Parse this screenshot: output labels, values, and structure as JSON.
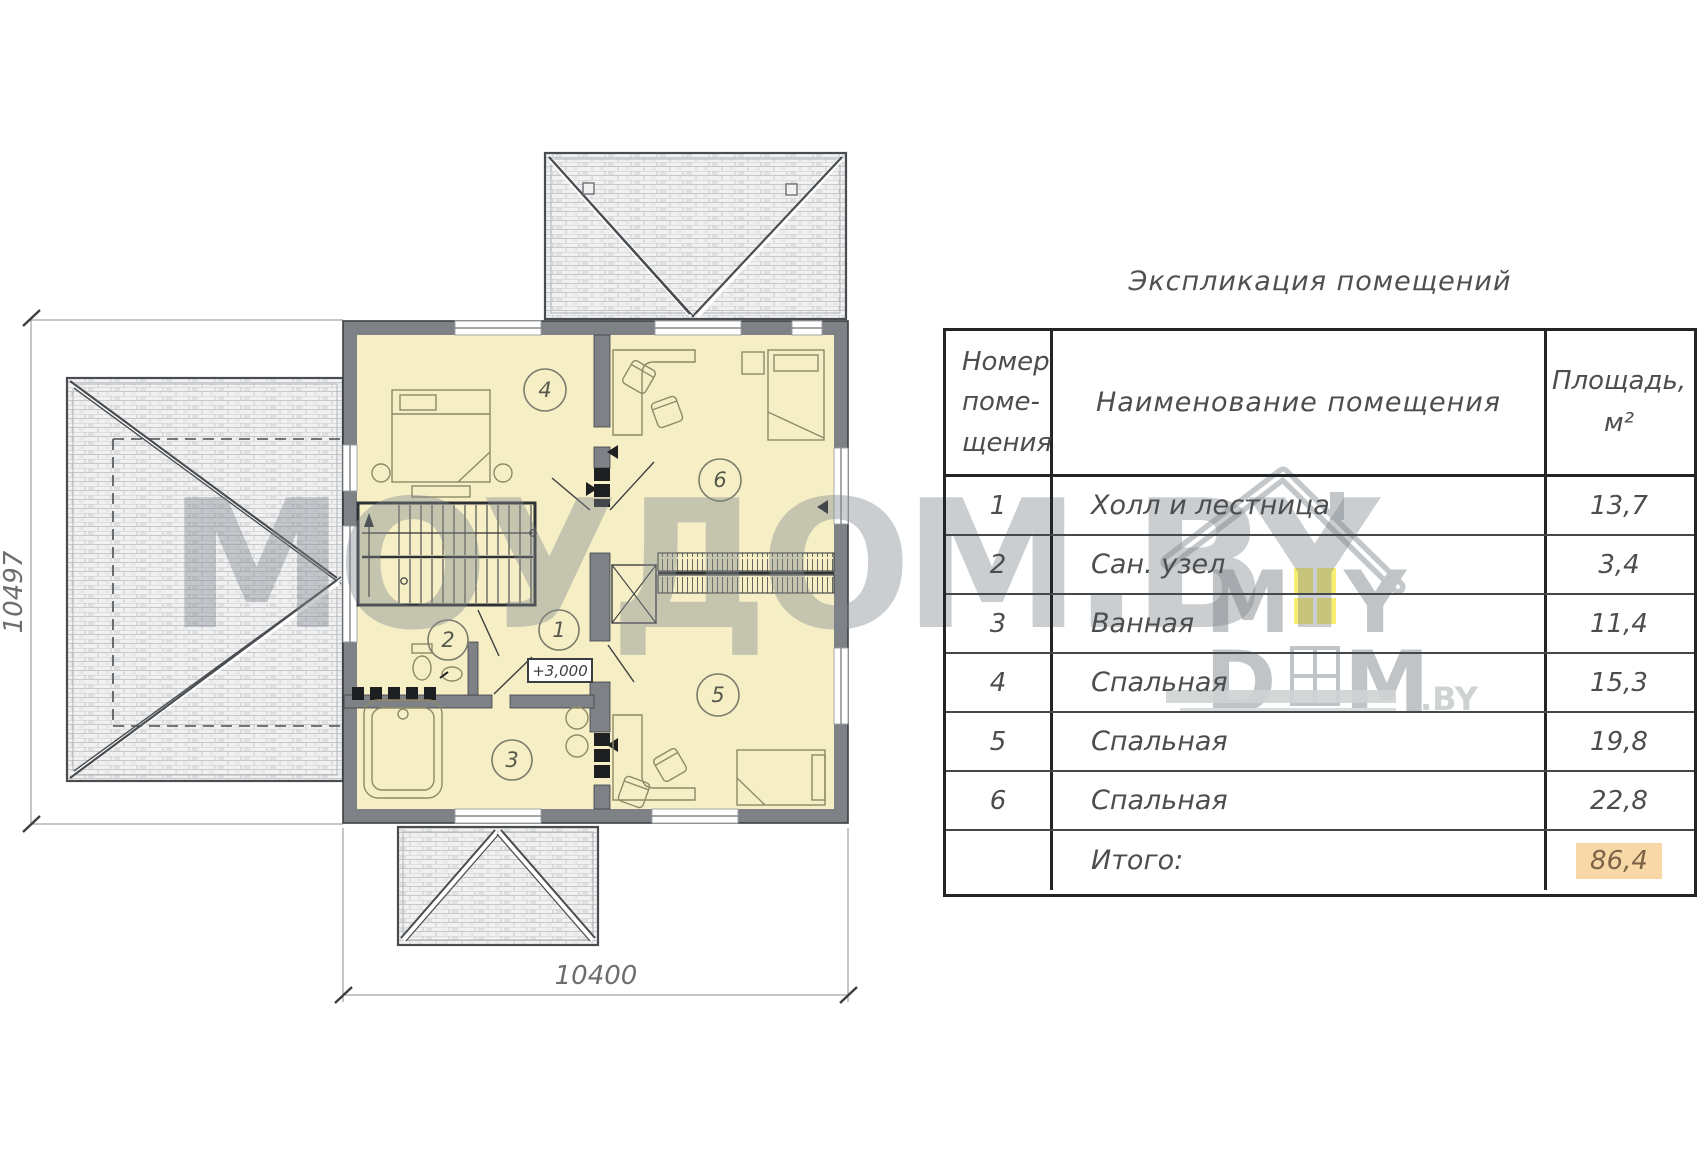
{
  "watermark": {
    "big_text": "МОУДОМ.BY",
    "logo": {
      "m1": "M",
      "y1": "Y",
      "d2": "D",
      "m2": "M",
      "suffix": ".BY"
    }
  },
  "plan": {
    "dim_left": "10497",
    "dim_bottom": "10400",
    "elevation": "+3,000",
    "rooms": [
      {
        "number": "1"
      },
      {
        "number": "2"
      },
      {
        "number": "3"
      },
      {
        "number": "4"
      },
      {
        "number": "5"
      },
      {
        "number": "6"
      }
    ]
  },
  "table": {
    "title": "Экспликация помещений",
    "header": {
      "col1_line1": "Номер",
      "col1_line2": "поме-",
      "col1_line3": "щения",
      "col2": "Наименование помещения",
      "col3_line1": "Площадь,",
      "col3_line2": "м²"
    },
    "rows": [
      {
        "num": "1",
        "name": "Холл и лестница",
        "area": "13,7"
      },
      {
        "num": "2",
        "name": "Сан. узел",
        "area": "3,4"
      },
      {
        "num": "3",
        "name": "Ванная",
        "area": "11,4"
      },
      {
        "num": "4",
        "name": "Спальная",
        "area": "15,3"
      },
      {
        "num": "5",
        "name": "Спальная",
        "area": "19,8"
      },
      {
        "num": "6",
        "name": "Спальная",
        "area": "22,8"
      }
    ],
    "total": {
      "label": "Итого:",
      "value": "86,4"
    }
  },
  "colors": {
    "wall_gray": "#7e8287",
    "room_fill": "#f6efc6",
    "roof_fill": "#f1f1f2",
    "total_highlight": "#f7d8a6",
    "watermark_gray": "#82898f",
    "logo_yellow": "#f6e94e"
  }
}
